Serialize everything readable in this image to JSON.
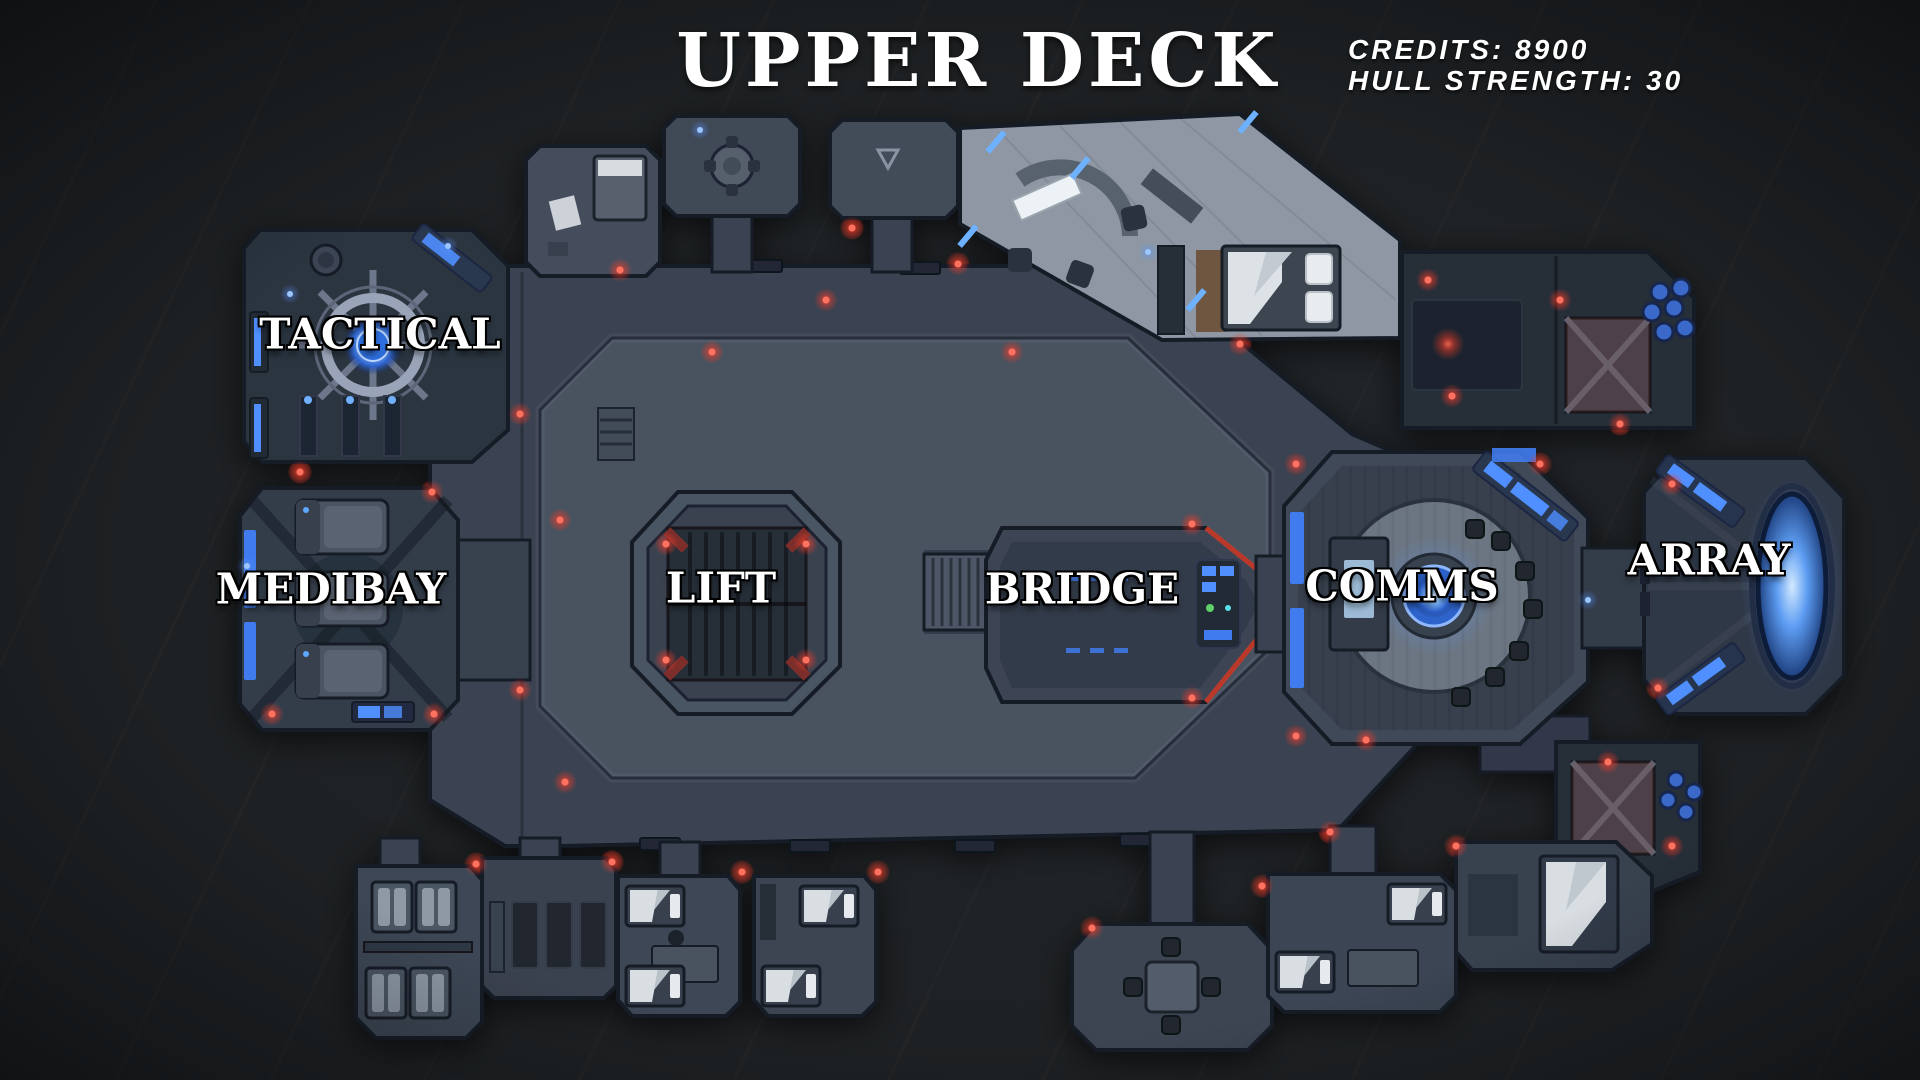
{
  "title": "UPPER DECK",
  "hud": {
    "credits": "CREDITS: 8900",
    "credits_value": 8900,
    "hull_strength": "HULL STRENGTH: 30",
    "hull_strength_value": 30
  },
  "rooms": [
    {
      "id": "tactical",
      "label": "TACTICAL"
    },
    {
      "id": "medibay",
      "label": "MEDIBAY"
    },
    {
      "id": "lift",
      "label": "LIFT"
    },
    {
      "id": "bridge",
      "label": "BRIDGE"
    },
    {
      "id": "comms",
      "label": "COMMS"
    },
    {
      "id": "array",
      "label": "ARRAY"
    }
  ],
  "colors": {
    "background": "#1e2123",
    "hull_plate": "#3a4351",
    "hull_outline": "#141a25",
    "accent_blue": "#4f8fff",
    "accent_red": "#ff4a3a",
    "label_text": "#ffffff"
  }
}
